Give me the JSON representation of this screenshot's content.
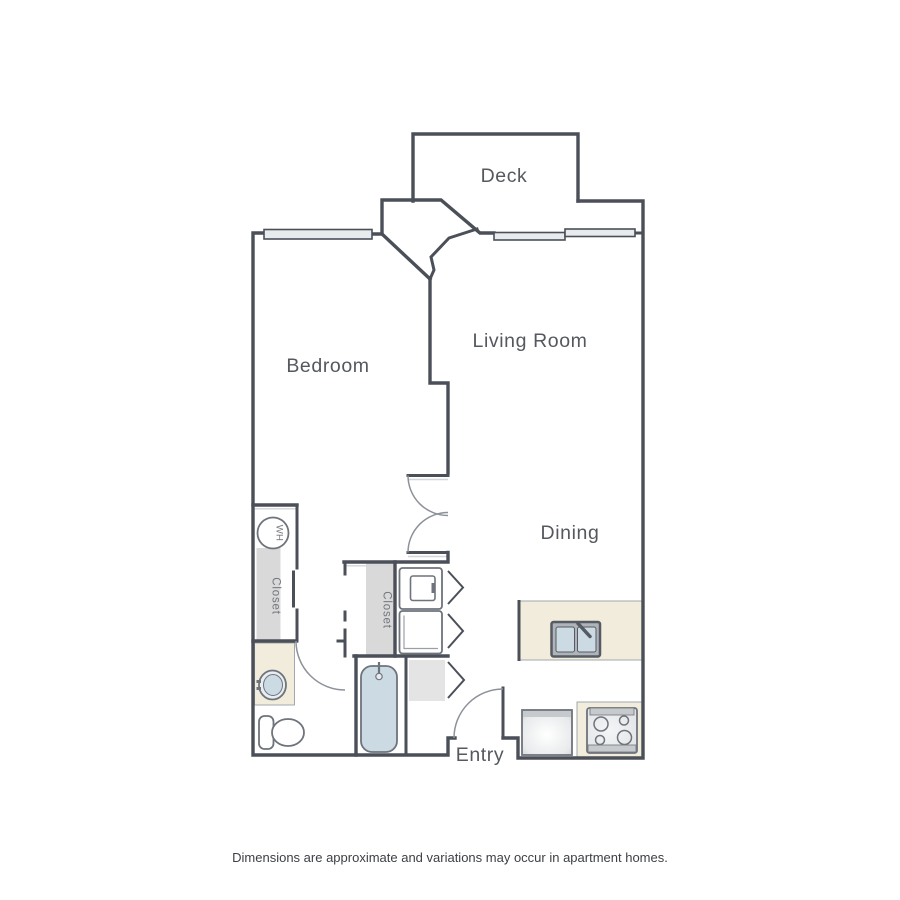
{
  "floorplan": {
    "room_labels": {
      "deck": "Deck",
      "living_room": "Living Room",
      "bedroom": "Bedroom",
      "dining": "Dining",
      "entry": "Entry"
    },
    "fixture_labels": {
      "bedroom_closet": "Closet",
      "hall_closet": "Closet",
      "water_heater": "WH"
    },
    "disclaimer": "Dimensions are approximate and variations may occur in apartment homes.",
    "colors": {
      "wall": "#4a4f58",
      "counter_beige": "#f1ecdb",
      "fixture_blue": "#ccdae3",
      "shelf_gray": "#d9d9d9",
      "storage_gray": "#e4e4e4",
      "window_fill": "#e7ebee",
      "appliance_band_gray": "#c6cacd",
      "sink_rim_gray": "#aeb4ba",
      "label_text": "#55585e",
      "fixture_stroke": "#6e737c",
      "door_arc": "#8d929a"
    }
  }
}
